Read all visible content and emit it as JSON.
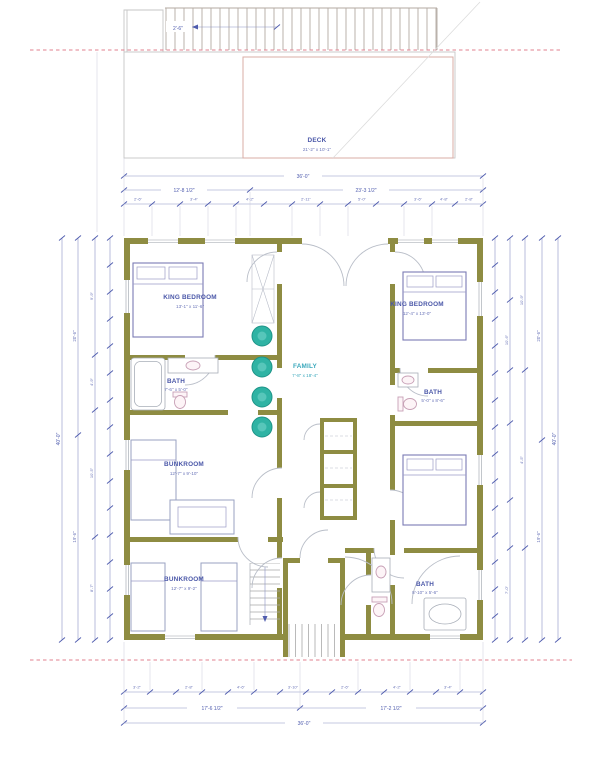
{
  "drawing": {
    "type": "second-floor residential plan with deck",
    "colors": {
      "wall": "#8e8c42",
      "dimension": "#4f5cae",
      "room_label": "#4a57a8",
      "family_label": "#3ba8bc",
      "appliance_teal": "#2fb3a4",
      "setback_dash_pink": "#e2808f",
      "deck_outline": "#d9aca6"
    }
  },
  "rooms": {
    "deck": {
      "label": "DECK",
      "dims": "21'-2\" x 10'-1\""
    },
    "king1": {
      "label": "KING BEDROOM",
      "dims": "13'-1\" x 11'-6\""
    },
    "king2": {
      "label": "KING BEDROOM",
      "dims": "12'-4\" x 13'-0\""
    },
    "family": {
      "label": "FAMILY",
      "dims": "7'-8\" x 18'-4\""
    },
    "bath1": {
      "label": "BATH",
      "dims": "7'-6\" x 5'-0\""
    },
    "bath2": {
      "label": "BATH",
      "dims": "5'-0\" x 8'-6\""
    },
    "bath3": {
      "label": "BATH",
      "dims": "8'-10\" x 5'-6\""
    },
    "bunk1": {
      "label": "BUNKROOM",
      "dims": "12'-7\" x 9'-10\""
    },
    "bunk2": {
      "label": "BUNKROOM",
      "dims": "12'-7\" x 9'-2\""
    }
  },
  "dims": {
    "deck_depth": "2'-6\"",
    "top_overall": "36'-0\"",
    "top_seg_left": "12'-8 1/2\"",
    "top_seg_right": "23'-3 1/2\"",
    "top_small": [
      "2'-6\"",
      "3'-4\"",
      "4'-2\"",
      "2'-11\"",
      "5'-0\"",
      "3'-6\"",
      "4'-8\"",
      "2'-8\""
    ],
    "bottom_overall": "36'-0\"",
    "bottom_seg_left": "17'-6 1/2\"",
    "bottom_seg_right": "17'-2 1/2\"",
    "bottom_small": [
      "3'-2\"",
      "2'-8\"",
      "4'-6\"",
      "3'-10\"",
      "2'-6\"",
      "4'-2\"",
      "3'-4\""
    ],
    "left_overall": "40'-0\"",
    "left_seg_a": "20'-6\"",
    "left_seg_b": "19'-6\"",
    "left_small": [
      "9'-9\"",
      "4'-9\"",
      "10'-5\"",
      "8'-7\""
    ],
    "right_overall": "40'-0\"",
    "right_seg_a": "20'-6\"",
    "right_seg_b": "19'-6\"",
    "right_small": [
      "10'-9\"",
      "4'-5\"",
      "10'-6\"",
      "7'-0\""
    ]
  }
}
